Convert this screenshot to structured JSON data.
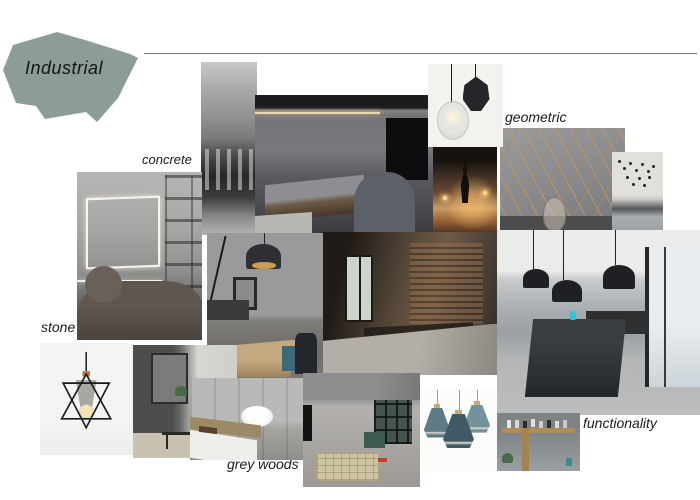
{
  "board": {
    "title": "Industrial",
    "labels": {
      "concrete": "concrete",
      "geometric": "geometric",
      "stone": "stone",
      "grey_woods": "grey woods",
      "functionality": "functionality"
    },
    "palette": {
      "badge_fill": "#8C9D99",
      "background": "#FFFFFF",
      "divider_line": "#7A7A7A",
      "label_text": "#1A1A1A",
      "brass_inlay": "#B08C5A",
      "teal_accent": "#2FC7D6",
      "teal_lamp": "#5D7A85",
      "warm_led": "#ECD9AA"
    },
    "photos": [
      {
        "name": "concrete-facade",
        "caption": "black and white concrete building interior"
      },
      {
        "name": "bedroom-suite",
        "caption": "dark bedroom with concrete wall and LED cove lighting"
      },
      {
        "name": "pendant-lamp-card",
        "caption": "black faceted and clear glass pendant lamps on white"
      },
      {
        "name": "decor-objects",
        "caption": "warm-lit shelf with candlesticks and ornaments"
      },
      {
        "name": "geometric-wall",
        "caption": "grey wall with brass geometric line inlays and glass vase"
      },
      {
        "name": "hanging-bulbs-lounge",
        "caption": "cluster of black hanging bulbs over grey sofa"
      },
      {
        "name": "concrete-living-room",
        "caption": "concrete wall with LED outline, dark sofa and shelves"
      },
      {
        "name": "arc-lamp-dining",
        "caption": "dining room with black dome pendant, arc lamp and wood table"
      },
      {
        "name": "cafe-interior",
        "caption": "industrial cafe with brick wall and concrete floor"
      },
      {
        "name": "kitchen-loft",
        "caption": "grey kitchen island with three black industrial pendants and window"
      },
      {
        "name": "loft-living-room",
        "caption": "loft room with concrete ceiling, glazed partition and rug"
      },
      {
        "name": "grey-woods-bedroom",
        "caption": "bedroom with grey wood panels and white bowl"
      },
      {
        "name": "living-room-plants",
        "caption": "grey living room with mirror, plants and rug"
      },
      {
        "name": "stone-pendant-card",
        "caption": "wire-frame pendant lamp with concrete shade on white"
      },
      {
        "name": "teal-pendant-lamps",
        "caption": "cluster of teal cone pendant lamps with wood tops"
      },
      {
        "name": "wood-shelf-vases",
        "caption": "wooden shelf with vases and plant on grey wall"
      }
    ]
  }
}
